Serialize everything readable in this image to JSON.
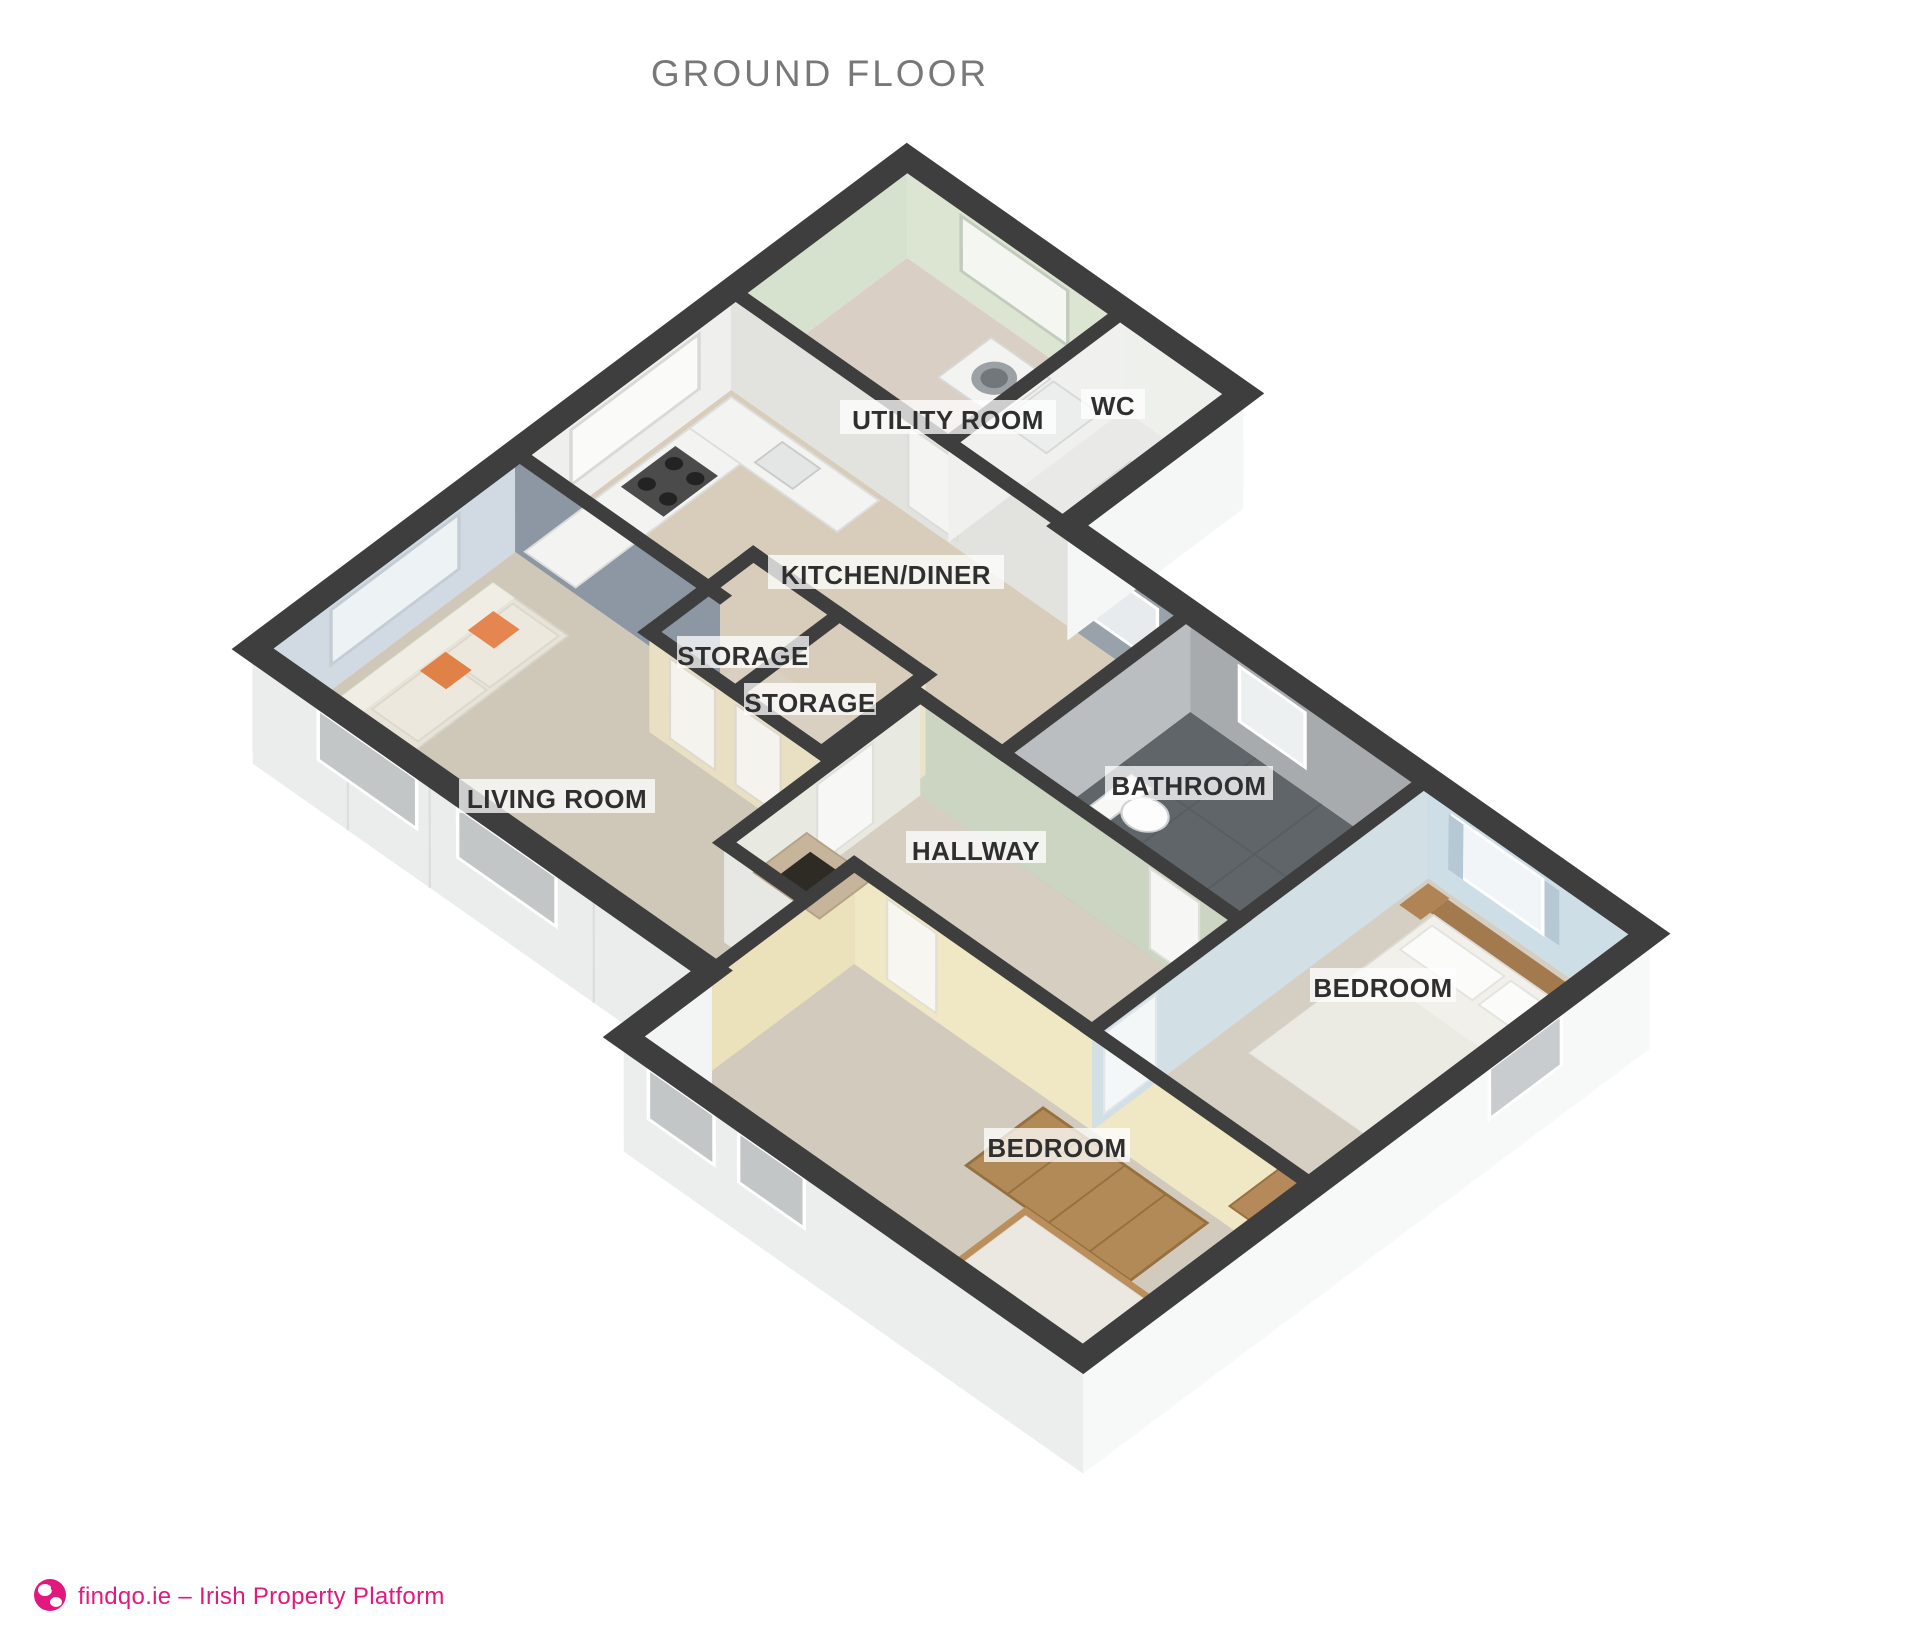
{
  "title": "GROUND FLOOR",
  "rooms": {
    "utility_room": "UTILITY ROOM",
    "wc": "WC",
    "kitchen_diner": "KITCHEN/DINER",
    "storage_1": "STORAGE",
    "storage_2": "STORAGE",
    "living_room": "LIVING ROOM",
    "bathroom": "BATHROOM",
    "hallway": "HALLWAY",
    "bedroom_1": "BEDROOM",
    "bedroom_2": "BEDROOM"
  },
  "branding": {
    "site": "findqo.ie – Irish Property Platform"
  },
  "colors": {
    "brand_pink": "#e2187f",
    "title_gray": "#787878",
    "wall_top": "#3e3e3e",
    "label_text": "#2f2f2f"
  }
}
